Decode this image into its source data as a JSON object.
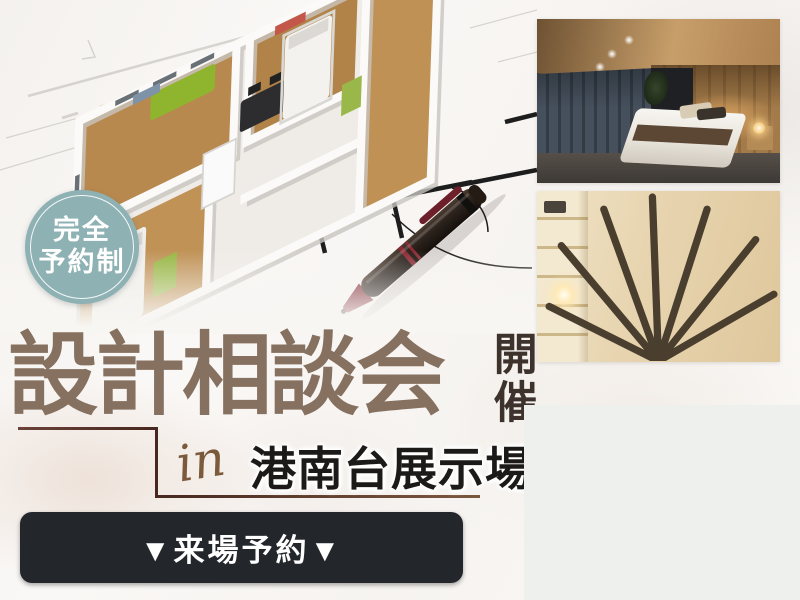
{
  "banner": {
    "badge": {
      "line1": "完全",
      "line2": "予約制",
      "bg_color": "#8EB1B3"
    },
    "title": {
      "text": "設計相談会",
      "color": "#86705F"
    },
    "subtitle": {
      "text": "開催",
      "color": "#3E332C"
    },
    "location": {
      "prefix": "in",
      "name": "港南台展示場",
      "prefix_color": "#7A5A3A",
      "name_color": "#1C1A19"
    },
    "cta": {
      "label": "▼来場予約▼",
      "bg_color": "#23262B",
      "text_color": "#FFFFFF"
    },
    "accent_line_color": "#47281F"
  },
  "photos": [
    {
      "name": "floorplan-3d-model-with-pen"
    },
    {
      "name": "bedroom-interior"
    },
    {
      "name": "entryway-interior"
    },
    {
      "name": "modern-house-exterior"
    }
  ]
}
